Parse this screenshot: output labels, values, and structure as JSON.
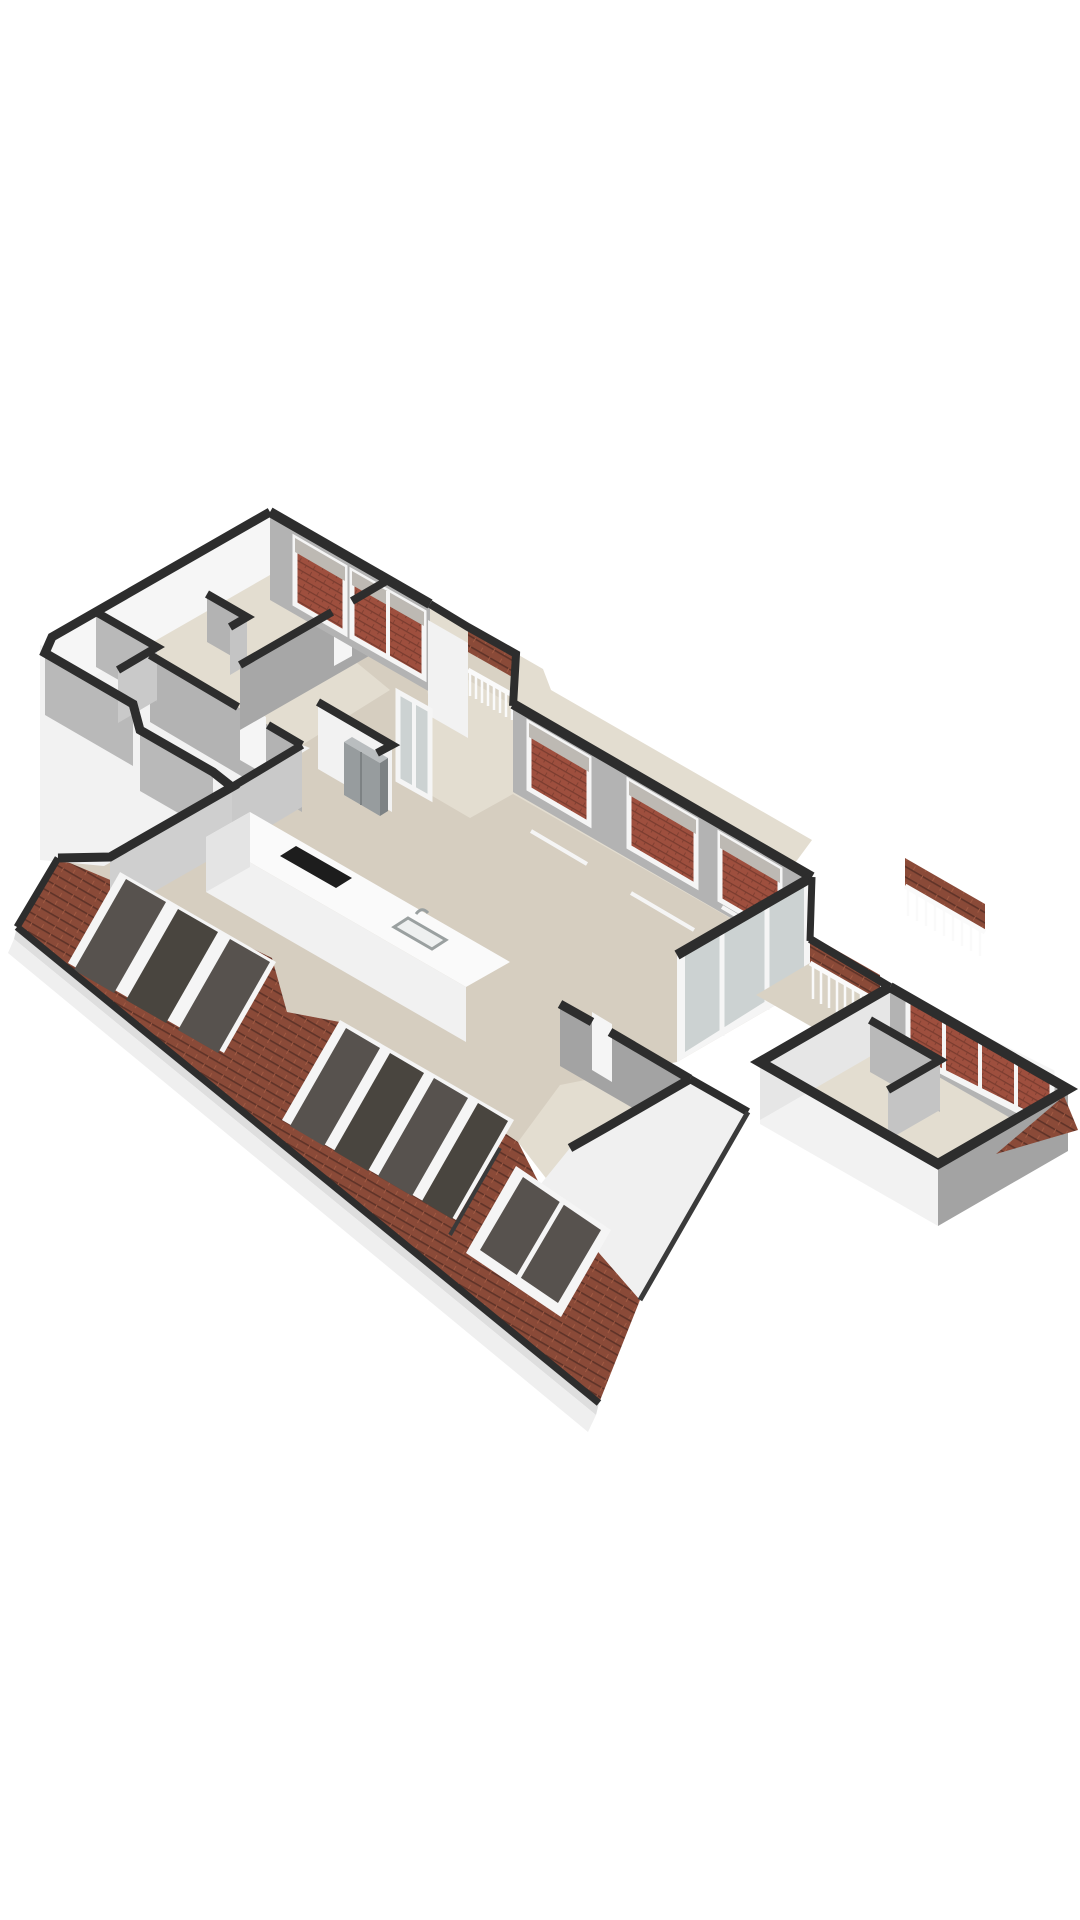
{
  "scene": {
    "type": "3d-floorplan-render",
    "background": "#ffffff",
    "view": "isometric-top-down"
  },
  "colors": {
    "background": "#ffffff",
    "wall_cap": "#2d2d2d",
    "wall_cap_soft": "#3a3a3a",
    "wall_inner_mid": "#b3b3b3",
    "wall_inner_mid2": "#b9b9b9",
    "wall_inner_dark": "#a3a3a3",
    "wall_inner_dark2": "#a7a7a7",
    "wall_inner_dark3": "#9e9e9e",
    "wall_inner_light": "#c9c9c9",
    "wall_inner_light2": "#cfcfcf",
    "wall_inner_light3": "#c4c4c4",
    "wall_outer": "#f2f2f2",
    "wall_outer_bright": "#f6f6f6",
    "wall_outer_dim": "#e6e6e6",
    "wall_outer_mass": "#f0f0f0",
    "floor_main": "#d6cec0",
    "floor_light": "#e3ddd0",
    "floor_balcony": "#d9d2c4",
    "roof_tile": "#8a4a38",
    "roof_tile_line": "#5f3328",
    "roof_tile_light": "#a05a43",
    "brick": "#9e4f3e",
    "brick_line": "#7a3c2f",
    "skylight_glass": "#57524e",
    "skylight_glass_dark": "#49453f",
    "frame_white": "#f5f5f5",
    "glass_pane": "#ccd2d2",
    "window_sky": "#bdb9b3",
    "railing": "#fafafa",
    "fascia": "#dedede",
    "fascia_light": "#efefef",
    "island_top": "#fafafa",
    "island_front": "#f1f1f1",
    "island_side": "#e4e4e4",
    "cooktop": "#1d1d1d",
    "sink_fill": "#eef0f0",
    "sink_line": "#9aa0a0",
    "fridge_front": "#979c9e",
    "fridge_side": "#7d8284",
    "fridge_top": "#b9bdbf"
  },
  "features": {
    "skylight_cluster_left_panes": 3,
    "skylight_cluster_middle_panes": 4,
    "skylight_bottom_panes": 2,
    "top_room_windows": 2,
    "window_band_windows": 3,
    "wing_window_sections": 4,
    "balcony_railings": 3,
    "glass_door_walls": 2,
    "kitchen_island": true,
    "island_cooktop": true,
    "island_sink": true,
    "fridge": true,
    "roof_sections": 2
  }
}
